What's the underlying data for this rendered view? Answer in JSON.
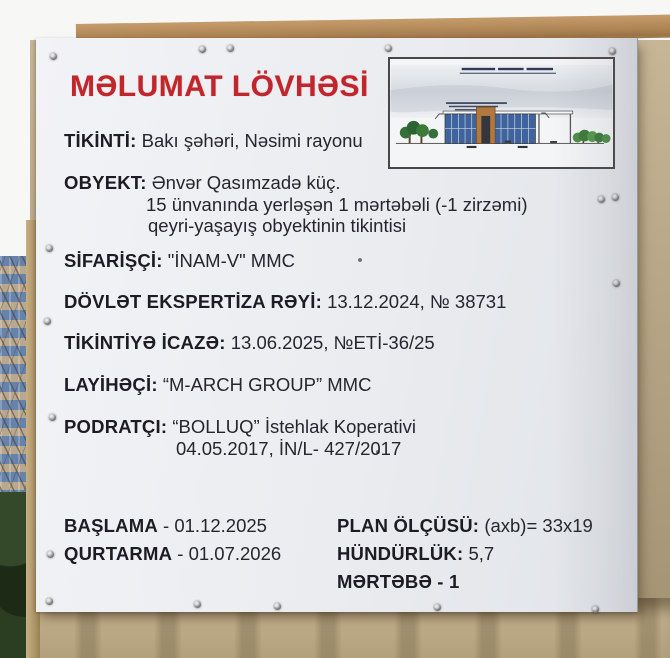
{
  "sign": {
    "title": "MƏLUMAT LÖVHƏSİ",
    "fields": [
      {
        "label": "TİKİNTİ:",
        "value": "Bakı şəhəri, Nəsimi rayonu"
      },
      {
        "label": "OBYEKT:",
        "value": "Ənvər Qasımzadə küç.",
        "value_line2": "15 ünvanında yerləşən 1 mərtəbəli (-1 zirzəmi)",
        "value_line3": "qeyri-yaşayış obyektinin tikintisi"
      },
      {
        "label": "SİFARİŞÇİ:",
        "value": "\"İNAM-V\" MMC"
      },
      {
        "label": "DÖVLƏT EKSPERTİZA RƏYİ:",
        "value": "13.12.2024,  № 38731"
      },
      {
        "label": "TİKİNTİYƏ İCAZƏ:",
        "value": "13.06.2025,  №ETİ-36/25"
      },
      {
        "label": "LAYİHƏÇİ:",
        "value": "“M-ARCH GROUP” MMC"
      },
      {
        "label": "PODRATÇI:",
        "value": "“BOLLUQ” İstehlak Koperativi",
        "value_line2": "04.05.2017, İN/L- 427/2017"
      }
    ],
    "schedule": [
      {
        "label": "BAŞLAMA",
        "value": "- 01.12.2025"
      },
      {
        "label": "QURTARMA",
        "value": "- 01.07.2026"
      }
    ],
    "specs": [
      {
        "label": "PLAN ÖLÇÜSÜ:",
        "value": "(axb)= 33x19"
      },
      {
        "label": "HÜNDÜRLÜK:",
        "value": "5,7"
      },
      {
        "label": "MƏRTƏBƏ",
        "value": "- 1"
      }
    ],
    "picture": {
      "name": "building-elevation-drawing"
    }
  },
  "colors": {
    "title_red": "#c0262b",
    "text": "#232329",
    "sign_background": "#edeff2",
    "wall_tan": "#b5a584",
    "beam_brown": "#ab8252",
    "drawing_glass_blue": "#3f639c",
    "drawing_wood_brown": "#b1793f",
    "drawing_tree_green": "#3c7a3a"
  }
}
